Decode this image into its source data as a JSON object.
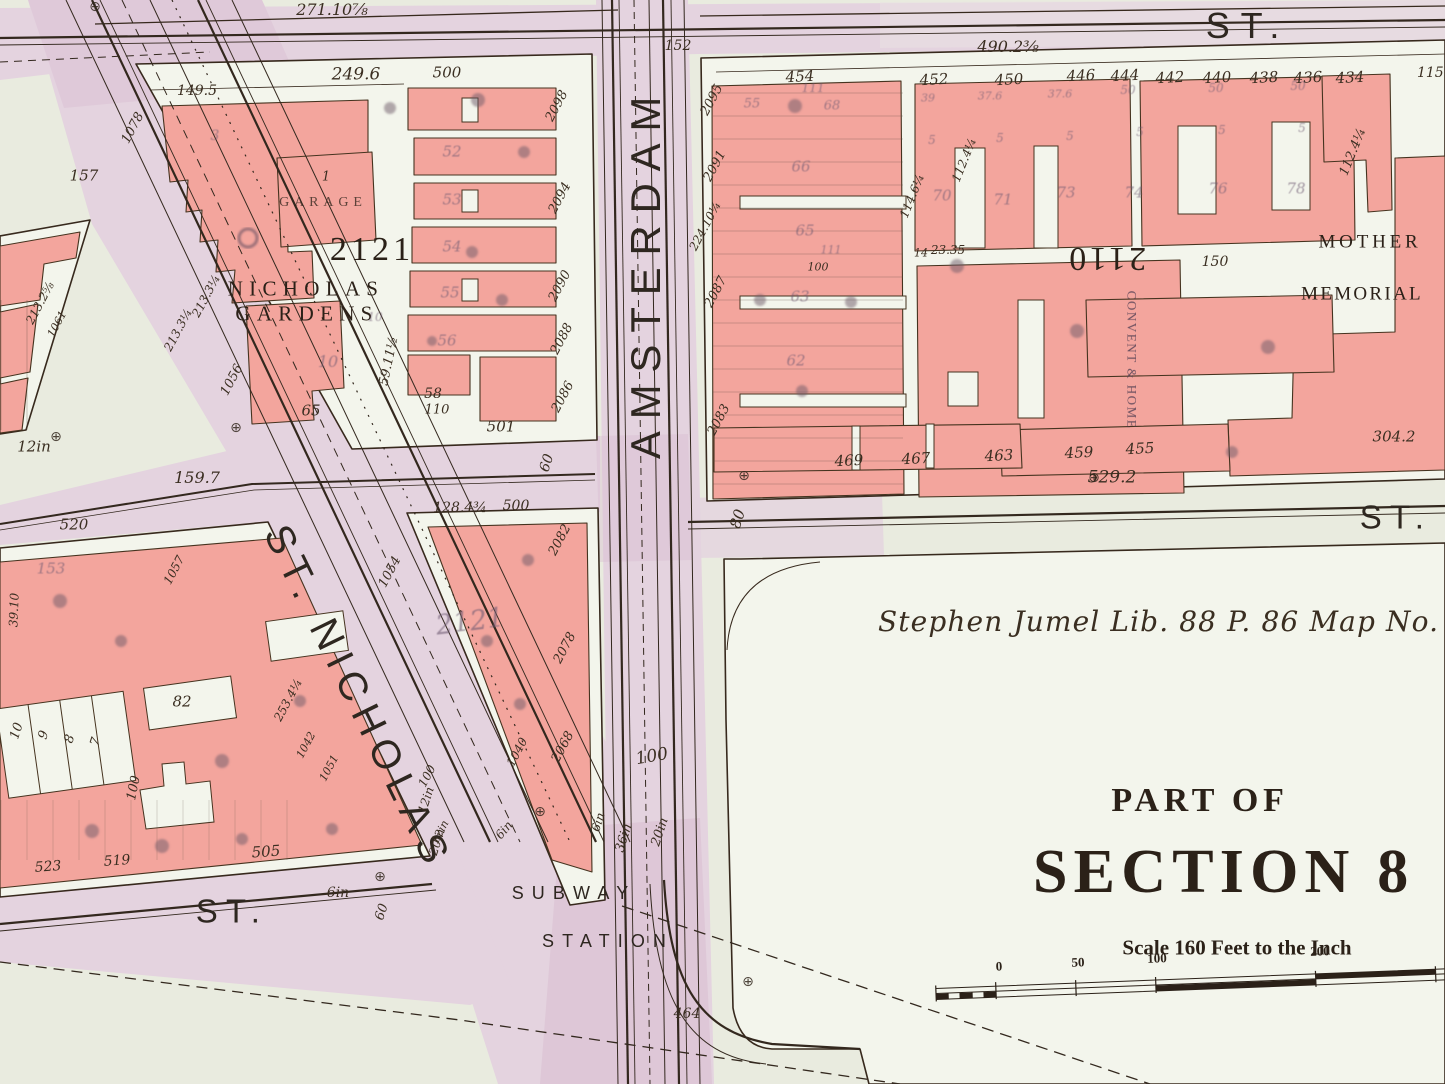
{
  "colors": {
    "paper": "#e9ebdf",
    "block_white": "#f3f5ec",
    "building_pink": "#f3a59d",
    "street_lavender": "#e4d3df",
    "ink": "#33281e",
    "stamp_purple": "#6e5a72"
  },
  "labels": {
    "monument": "⊕",
    "streets": {
      "top_st": "ST.",
      "mid_st": "ST.",
      "bottom_st": "ST.",
      "amsterdam": "AMSTERDAM",
      "st_nicholas": "ST. NICHOLAS",
      "subway1": "SUBWAY",
      "subway2": "STATION"
    },
    "blocks": {
      "b2121u": "2121",
      "b2121u_name1": "NICHOLAS",
      "b2121u_name2": "GARDENS",
      "garage": "GARAGE",
      "garage_lot": "1",
      "b2121l": "2121",
      "b2110": "2110",
      "convent": "CONVENT & HOME",
      "mother": "MOTHER",
      "memorial": "MEMORIAL"
    },
    "legend": {
      "part_of": "PART OF",
      "section": "SECTION 8",
      "scale": "Scale 160 Feet to the Inch",
      "jumel": "Stephen Jumel  Lib. 88  P. 86  Map No. 89",
      "ticks": [
        "0",
        "50",
        "100",
        "200"
      ]
    },
    "house_top": [
      "454",
      "452",
      "450",
      "446",
      "444",
      "442",
      "440",
      "438",
      "436",
      "434"
    ],
    "house_bottom": [
      "469",
      "467",
      "463",
      "459",
      "455"
    ],
    "houses_left": [
      "523",
      "519",
      "505"
    ],
    "dims": {
      "d271": "271.10⅞",
      "d157": "157",
      "d152": "152",
      "d490": "490.2⅜",
      "d115": "115.2",
      "d249": "249.6",
      "d149": "149.5",
      "d500a": "500",
      "d501": "501",
      "d110": "110",
      "d58": "58",
      "d65": "65",
      "d59": "59.11½",
      "d224": "224.10¼",
      "d1078": "1078",
      "d213a": "213.3¼",
      "d213b": "213.3¼",
      "d213c": "213.2⅝",
      "d1061": "1061",
      "d1056": "1056",
      "d1057": "1057",
      "d253": "253.4¼",
      "d1042": "1042",
      "d1051": "1051",
      "d1054": "1054",
      "d100dia": "100",
      "d12dia": "12in",
      "d159": "159.7",
      "d12in": "12in",
      "d520": "520",
      "d3910": "39.10",
      "d82": "82",
      "d100L": "100",
      "d60b": "60",
      "d6inb": "6in",
      "d60a": "60",
      "d80": "80",
      "d128": "128.4¾",
      "d500b": "500",
      "d1040": "1040",
      "d100c": "100",
      "d464": "464",
      "d304": "304.2",
      "d529": "529.2",
      "d150": "150",
      "d114": "114.6¼",
      "d112a": "112.4¼",
      "d112b": "112.4¼",
      "d14": "14",
      "d2335": "23.35",
      "d100b": "100",
      "d111t": "111"
    },
    "avenue_numbers": {
      "w2098": "2098",
      "w2094": "2094",
      "w2090": "2090",
      "w2088": "2088",
      "w2086": "2086",
      "t2082": "2082",
      "t2078": "2078",
      "t2068": "2068",
      "e2095": "2095",
      "e2091": "2091",
      "e2087": "2087",
      "e2083": "2083"
    },
    "pipes": {
      "p12": "12in",
      "p20b": "20in",
      "p6b": "6in",
      "p6a": "6in",
      "p36": "36in",
      "p20a": "20in"
    },
    "lots": {
      "l10": "10",
      "l9": "9",
      "l8": "8",
      "l7": "7",
      "d10a": "10",
      "d10b": "10",
      "d3": "3",
      "d153": "153",
      "s52": "52",
      "s53": "53",
      "s54": "54",
      "s55c": "55",
      "s56": "56",
      "s55": "55",
      "s68": "68",
      "s66": "66",
      "s65": "65",
      "s63": "63",
      "s62": "62",
      "s70": "70",
      "s71": "71",
      "s73": "73",
      "s74": "74",
      "s76": "76",
      "s78": "78",
      "s39": "39",
      "s376a": "37.6",
      "s376b": "37.6",
      "s50a": "50",
      "s50b": "50",
      "s50c": "50",
      "five": "5",
      "d111b": "111"
    }
  }
}
